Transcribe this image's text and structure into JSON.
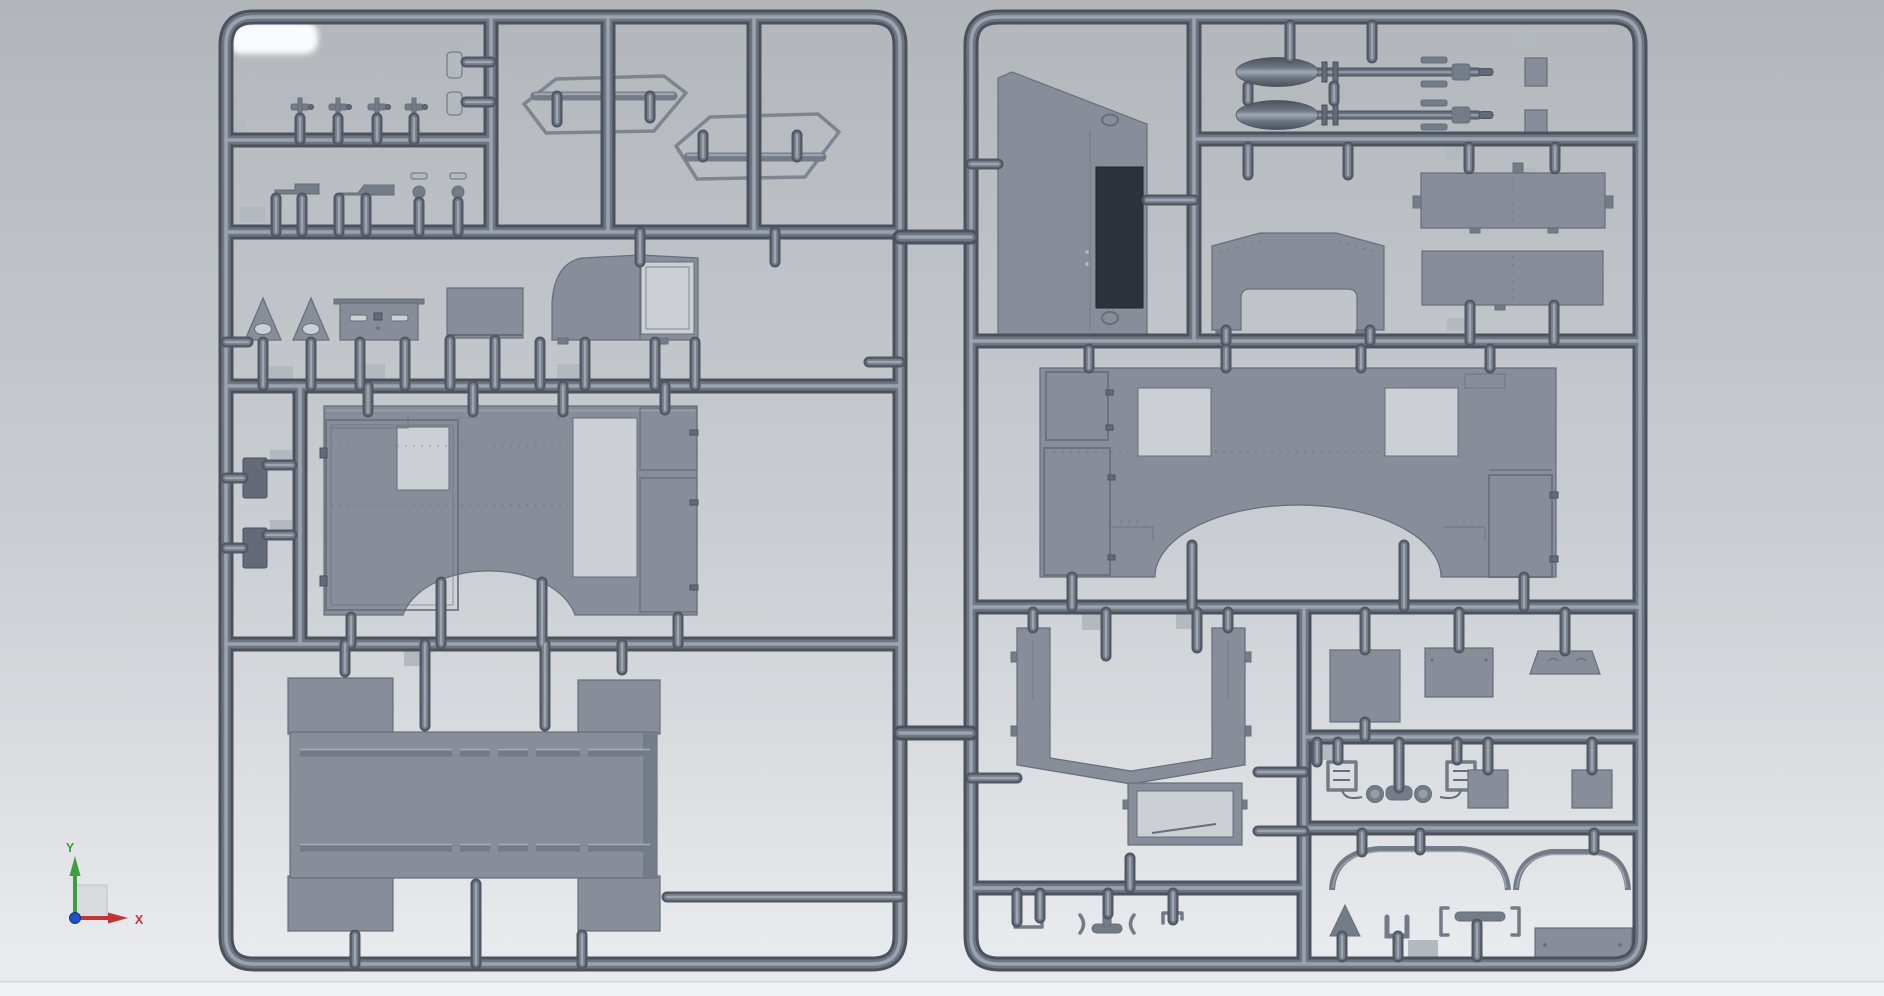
{
  "scene": {
    "description": "3D CAD viewport render of two gray injection-molded model kit sprues with parts",
    "sprues": [
      {
        "id": "left-sprue",
        "parts": [
          "reflection-highlight",
          "nozzle-parts",
          "plate-parts",
          "grab-handle-wires",
          "step-brackets",
          "cap-knobs",
          "warning-triangles",
          "hatch-panel",
          "flat-panel",
          "cab-side-panel",
          "stowage-boxes",
          "body-side-panel",
          "cargo-bed"
        ]
      },
      {
        "id": "right-sprue",
        "parts": [
          "door-panel",
          "missiles",
          "small-boxes",
          "gun-shield",
          "roof-panels",
          "body-side-panel",
          "equipment-boxes",
          "windshield-frame",
          "window-frame",
          "clamps",
          "mirror-assemblies",
          "stowage-lids",
          "fenders",
          "triangle",
          "u-channel",
          "bracket-tee",
          "base-plate"
        ]
      }
    ]
  },
  "gizmo": {
    "x_label": "X",
    "y_label": "Y"
  },
  "colors": {
    "bg_top": "#b2b6ba",
    "bg_mid": "#cbced2",
    "bg_bottom": "#e8eaed",
    "floor_strip": "#f0f1f3",
    "floor_line": "#d3d6d9",
    "tube_dark": "#4b525d",
    "tube_mid": "#6e7683",
    "tube_light": "#a0a8b3",
    "stud_dark": "#515863",
    "stud_mid": "#737b88",
    "stud_light": "#a6adb8",
    "part_fill": "#878e99",
    "part_edge": "#666e7a",
    "part_dark": "#747c88",
    "part_darker": "#636b78",
    "cutout": "#ccd0d4",
    "tab": "#b4b9c0",
    "white_highlight": "#fafbfc",
    "dark_box": "#626a77",
    "dark_window": "#2d323b",
    "axis_x": "#c23535",
    "axis_y": "#3d9e3d",
    "axis_z": "#2050c8",
    "plane_fill": "#d9dadd",
    "plane_edge": "#b9bcbf"
  }
}
